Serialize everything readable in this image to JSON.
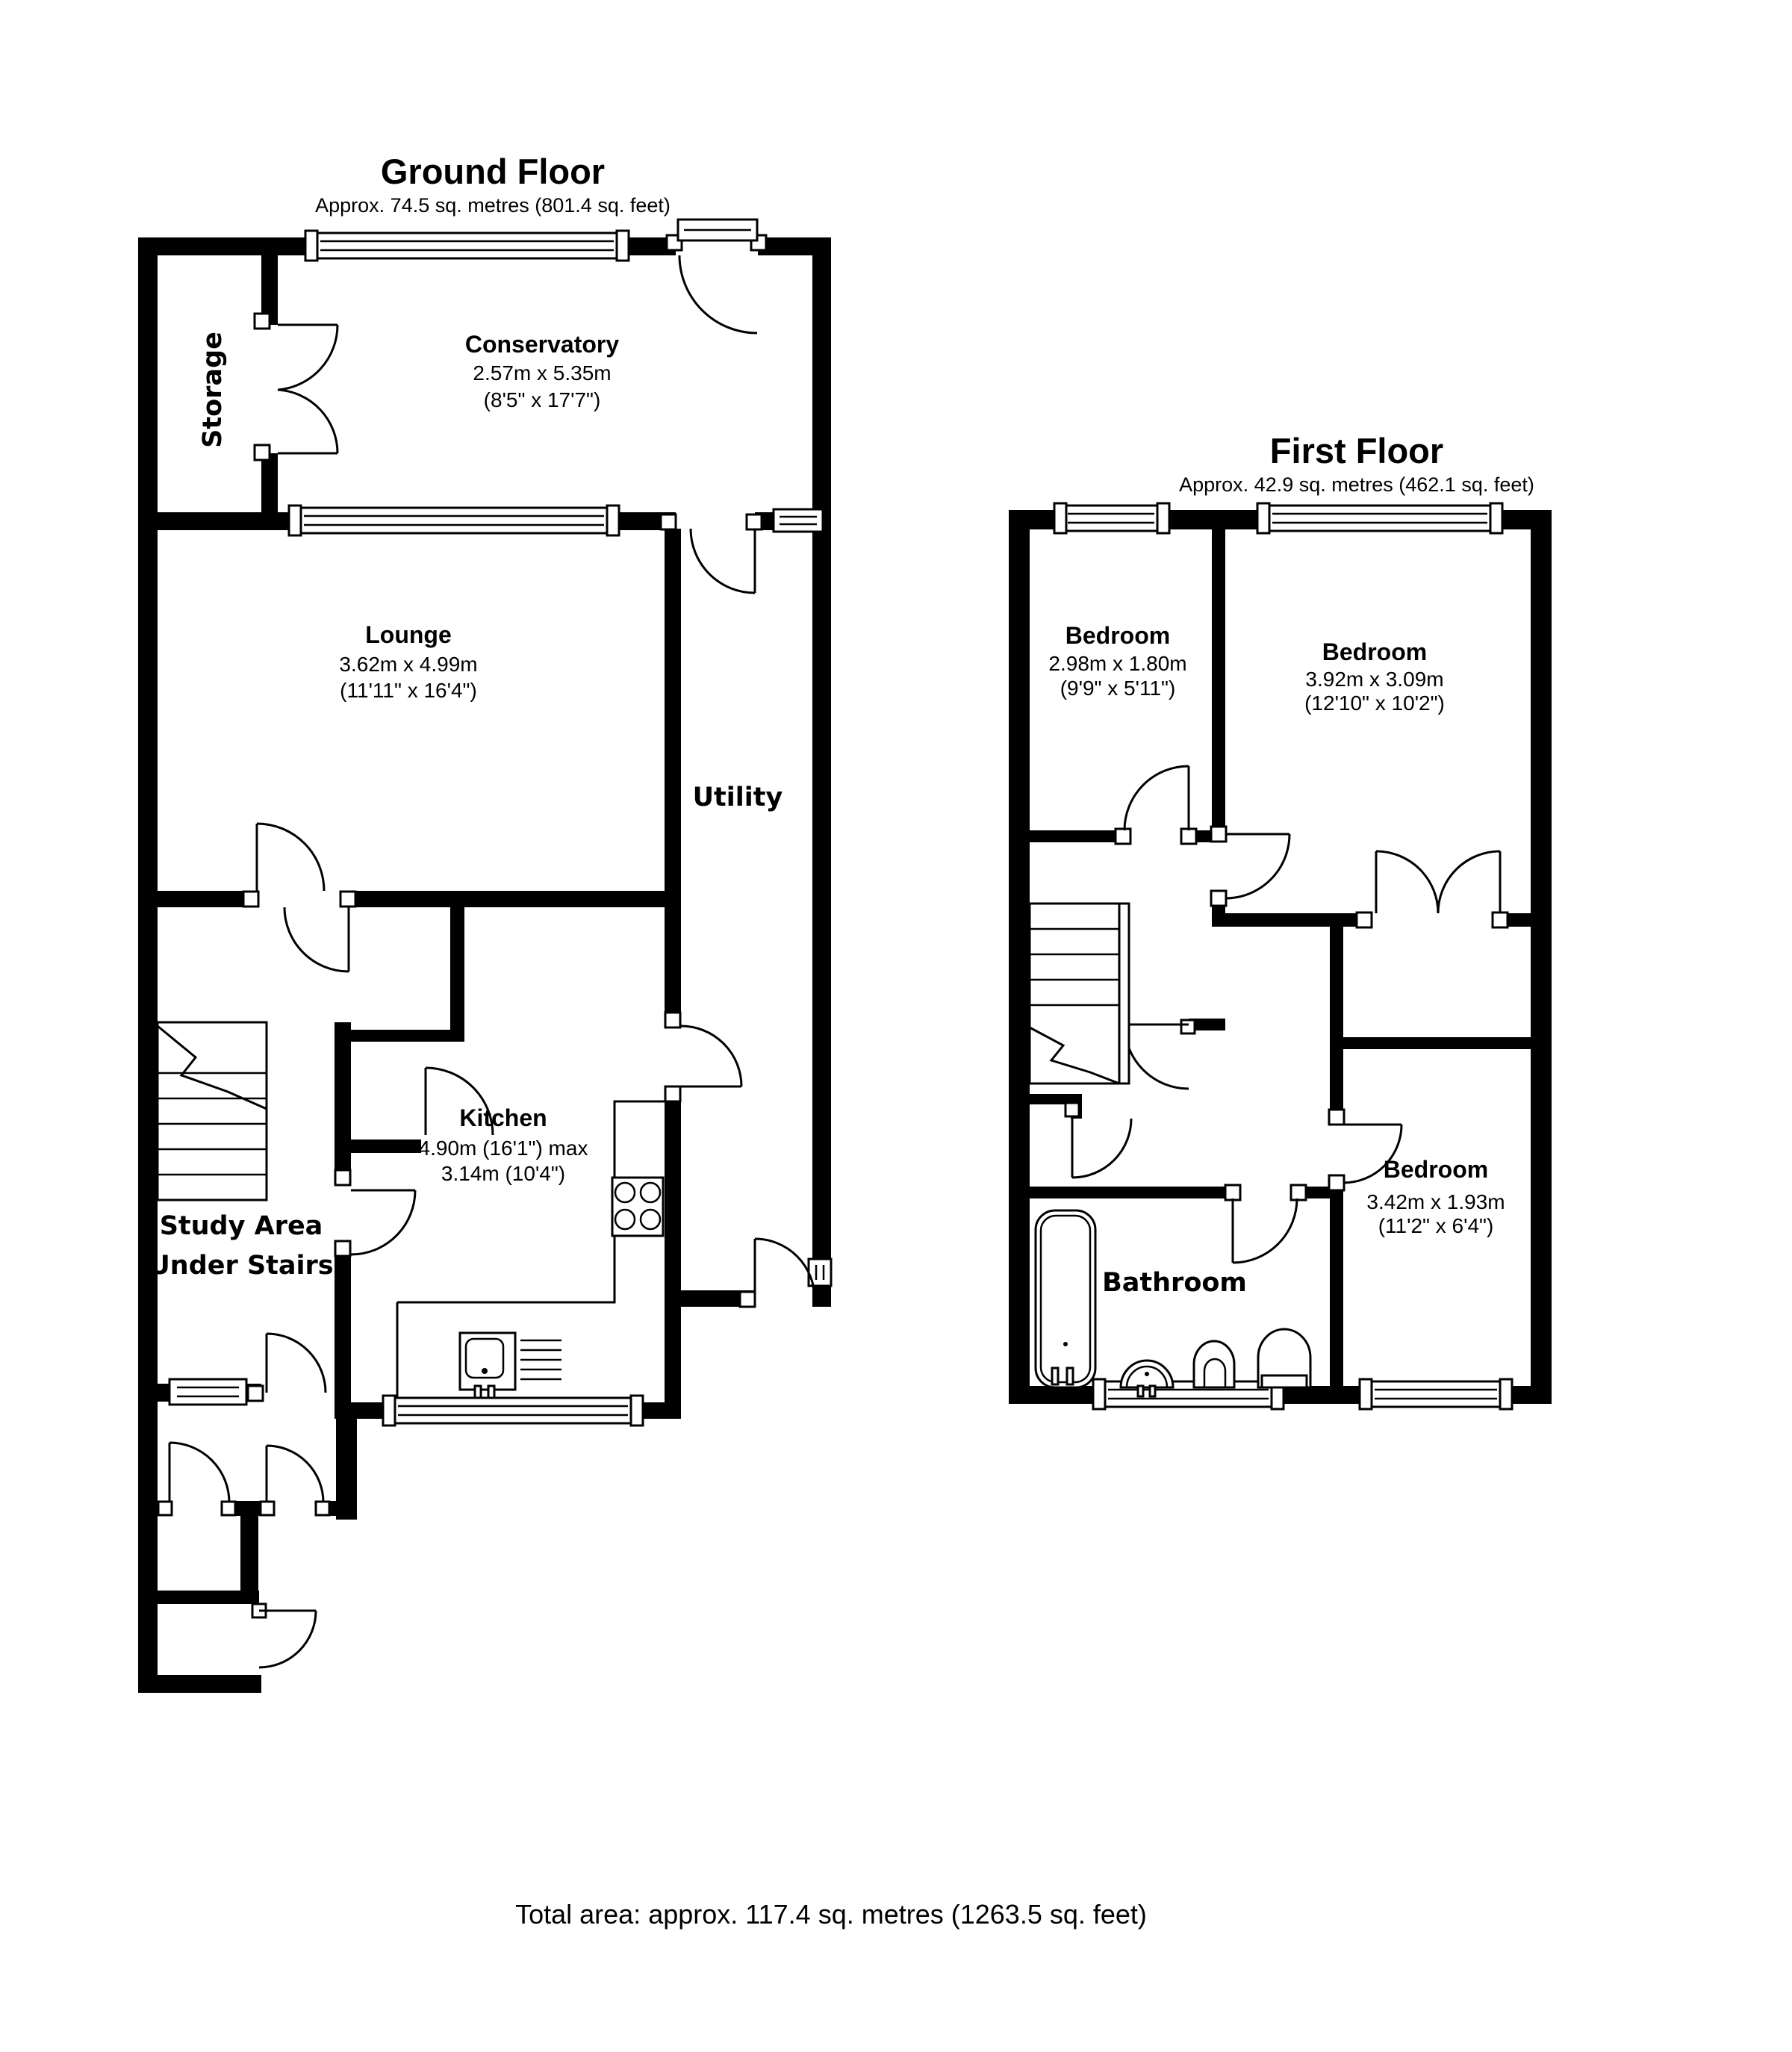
{
  "page": {
    "background": "#ffffff",
    "wall_color": "#000000",
    "text_color": "#000000"
  },
  "ground_floor": {
    "title": "Ground Floor",
    "subtitle": "Approx.  74.5 sq. metres (801.4 sq. feet)",
    "rooms": {
      "storage": {
        "name": "Storage"
      },
      "conservatory": {
        "name": "Conservatory",
        "dims_m": "2.57m x 5.35m",
        "dims_ft": "(8'5\" x 17'7\")"
      },
      "lounge": {
        "name": "Lounge",
        "dims_m": "3.62m x 4.99m",
        "dims_ft": "(11'11\" x 16'4\")"
      },
      "utility": {
        "name": "Utility"
      },
      "kitchen": {
        "name": "Kitchen",
        "dims_line1": "4.90m (16'1\") max",
        "dims_line2": "3.14m (10'4\")"
      },
      "study": {
        "line1": "Study Area",
        "line2": "Under Stairs"
      }
    }
  },
  "first_floor": {
    "title": "First Floor",
    "subtitle": "Approx.  42.9 sq. metres (462.1 sq. feet)",
    "rooms": {
      "bedroom_small": {
        "name": "Bedroom",
        "dims_m": "2.98m x 1.80m",
        "dims_ft": "(9'9\" x 5'11\")"
      },
      "bedroom_large": {
        "name": "Bedroom",
        "dims_m": "3.92m x 3.09m",
        "dims_ft": "(12'10\" x 10'2\")"
      },
      "bedroom_third": {
        "name": "Bedroom",
        "dims_m": "3.42m x 1.93m",
        "dims_ft": "(11'2\" x 6'4\")"
      },
      "bathroom": {
        "name": "Bathroom"
      }
    }
  },
  "footer": {
    "total_area": "Total area: approx. 117.4 sq. metres (1263.5 sq. feet)"
  }
}
